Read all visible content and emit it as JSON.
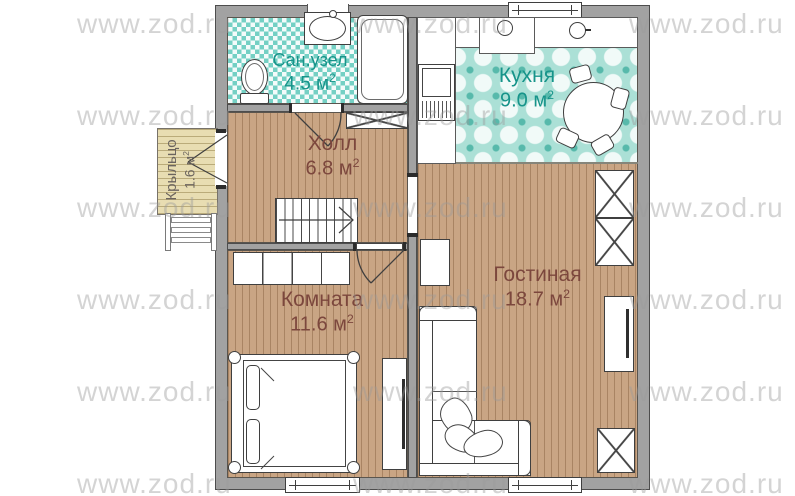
{
  "watermark": {
    "text": "www.zod.ru",
    "rows": [
      8,
      100,
      192,
      284,
      376,
      468
    ],
    "cols": [
      77,
      353,
      629
    ]
  },
  "rooms": {
    "bathroom": {
      "name": "Сан.узел",
      "area": "4.5 м",
      "sup": "2"
    },
    "kitchen": {
      "name": "Кухня",
      "area": "9.0 м",
      "sup": "2"
    },
    "hall": {
      "name": "Холл",
      "area": "6.8 м",
      "sup": "2"
    },
    "porch": {
      "name": "Крыльцо",
      "area": "1.6 м",
      "sup": "2"
    },
    "room": {
      "name": "Комната",
      "area": "11.6 м",
      "sup": "2"
    },
    "living": {
      "name": "Гостиная",
      "area": "18.7 м",
      "sup": "2"
    }
  },
  "colors": {
    "teal_label": "#17948a",
    "brown_label": "#7c473d",
    "porch_label": "#6b645e",
    "wall": "#a2a2a2",
    "wood_floor": "#c9a584",
    "bath_tile": "#74d0c4",
    "kitchen_tile": "#abe0d6",
    "porch_deck": "#e8ddb2",
    "watermark_color": "#9b9b9b"
  }
}
